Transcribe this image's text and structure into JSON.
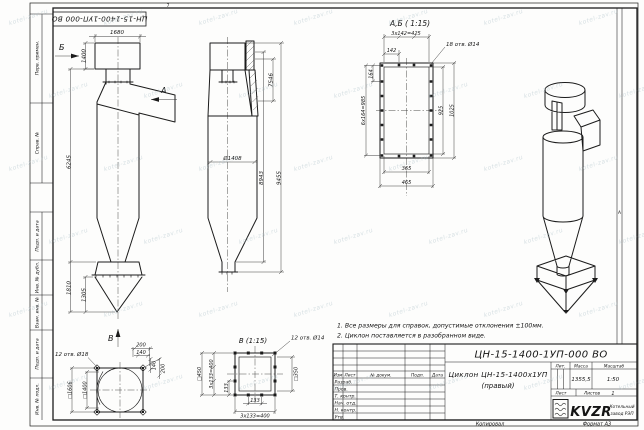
{
  "watermark": "kotel-zav.ru",
  "sheet": {
    "zone_top": "7",
    "zone_right": "А",
    "copied": "Копировал",
    "format": "Формат А3"
  },
  "margin": {
    "perv": "Перв. примен.",
    "sprav": "Справ. №",
    "podp1": "Подп. и дата",
    "inv_dubl": "Инв. № дубл.",
    "vzam": "Взам. инв. №",
    "podp2": "Подп. и дата",
    "inv_podl": "Инв. № подл."
  },
  "stamp": "ЦН-15-1400-1УП-000 ВО",
  "notes": [
    "1. Все размеры для справок, допустимые отклонения ±100мм.",
    "2. Циклон поставляется в разобранном виде."
  ],
  "front_view": {
    "label_a": "А",
    "label_b": "Б",
    "label_v": "В",
    "dim_1680": "1680",
    "dim_1400": "1400",
    "dim_6245": "6245",
    "dim_1810": "1810",
    "dim_1305": "1305"
  },
  "side_view": {
    "dim_d1408": "Ø1408",
    "dim_7546": "7546",
    "dim_8943": "8943",
    "dim_9455": "9455"
  },
  "flange_detail": {
    "title": "А,Б ( 1:15)",
    "dim_top": "3х142=425",
    "dim_142": "142",
    "holes": "18 отв. Ø14",
    "dim_164": "164",
    "dim_985": "6х164=985",
    "dim_925": "925",
    "dim_1025": "1025",
    "dim_365": "365",
    "dim_465": "465"
  },
  "base_detail": {
    "holes": "12 отв. Ø18",
    "dim_outer": "□1606",
    "dim_inner": "□1400",
    "dim_200t": "200",
    "dim_140t": "140",
    "dim_140r": "140",
    "dim_200r": "200"
  },
  "outlet_detail": {
    "title": "В (1:15)",
    "holes": "12 отв. Ø14",
    "dim_outer": "□450",
    "dim_left": "3х133=400",
    "dim_133l": "133",
    "dim_inner": "□350",
    "dim_133b": "133",
    "dim_bottom": "3х133=400"
  },
  "title_block": {
    "designation": "ЦН-15-1400-1УП-000 ВО",
    "name": "Циклон ЦН-15-1400х1УП",
    "name2": "(правый)",
    "h_izm": "Изм",
    "h_list": "Лист",
    "h_doc": "№ докум.",
    "h_podp": "Подп.",
    "h_data": "Дата",
    "rows": [
      "Разраб.",
      "Пров.",
      "Т. контр.",
      "Нач. отд.",
      "Н. контр.",
      "Утв."
    ],
    "h_lit": "Лит.",
    "h_massa": "Масса",
    "h_scale": "Масштаб",
    "massa": "1355,5",
    "scale": "1:50",
    "h_sheet": "Лист",
    "h_sheets": "Листов",
    "sheets": "1",
    "logo": "KVZR",
    "company1": "Котельный",
    "company2": "завод РЭП"
  }
}
